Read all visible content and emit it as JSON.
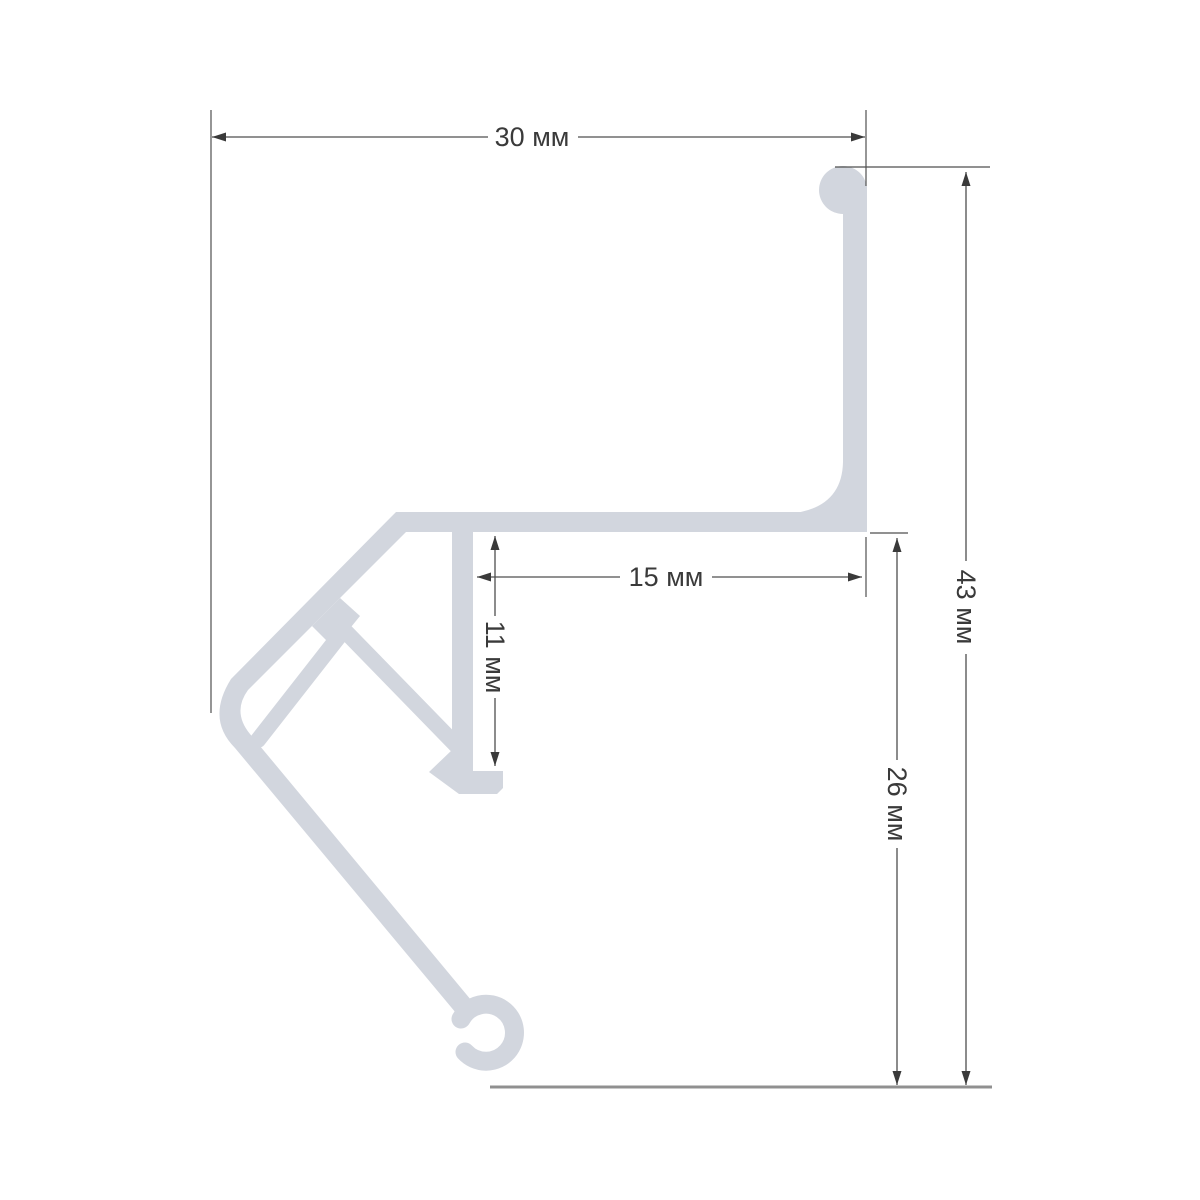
{
  "diagram": {
    "description": "Technical cross-section drawing of an aluminum profile with dimension callouts",
    "unit": "мм",
    "labels": {
      "top_width": "30 мм",
      "shelf_width": "15 мм",
      "web_height": "11 мм",
      "lower_height": "26 мм",
      "total_height": "43 мм"
    },
    "measurements": {
      "top_width_mm": 30,
      "shelf_width_mm": 15,
      "web_height_mm": 11,
      "lower_height_mm": 26,
      "total_height_mm": 43
    },
    "colors": {
      "profile": "#d2d6de",
      "dimension": "#4f4f4f",
      "arrow": "#3a3a3a",
      "label": "#3a3a3a",
      "baseline": "#909090",
      "background": "#ffffff"
    }
  }
}
